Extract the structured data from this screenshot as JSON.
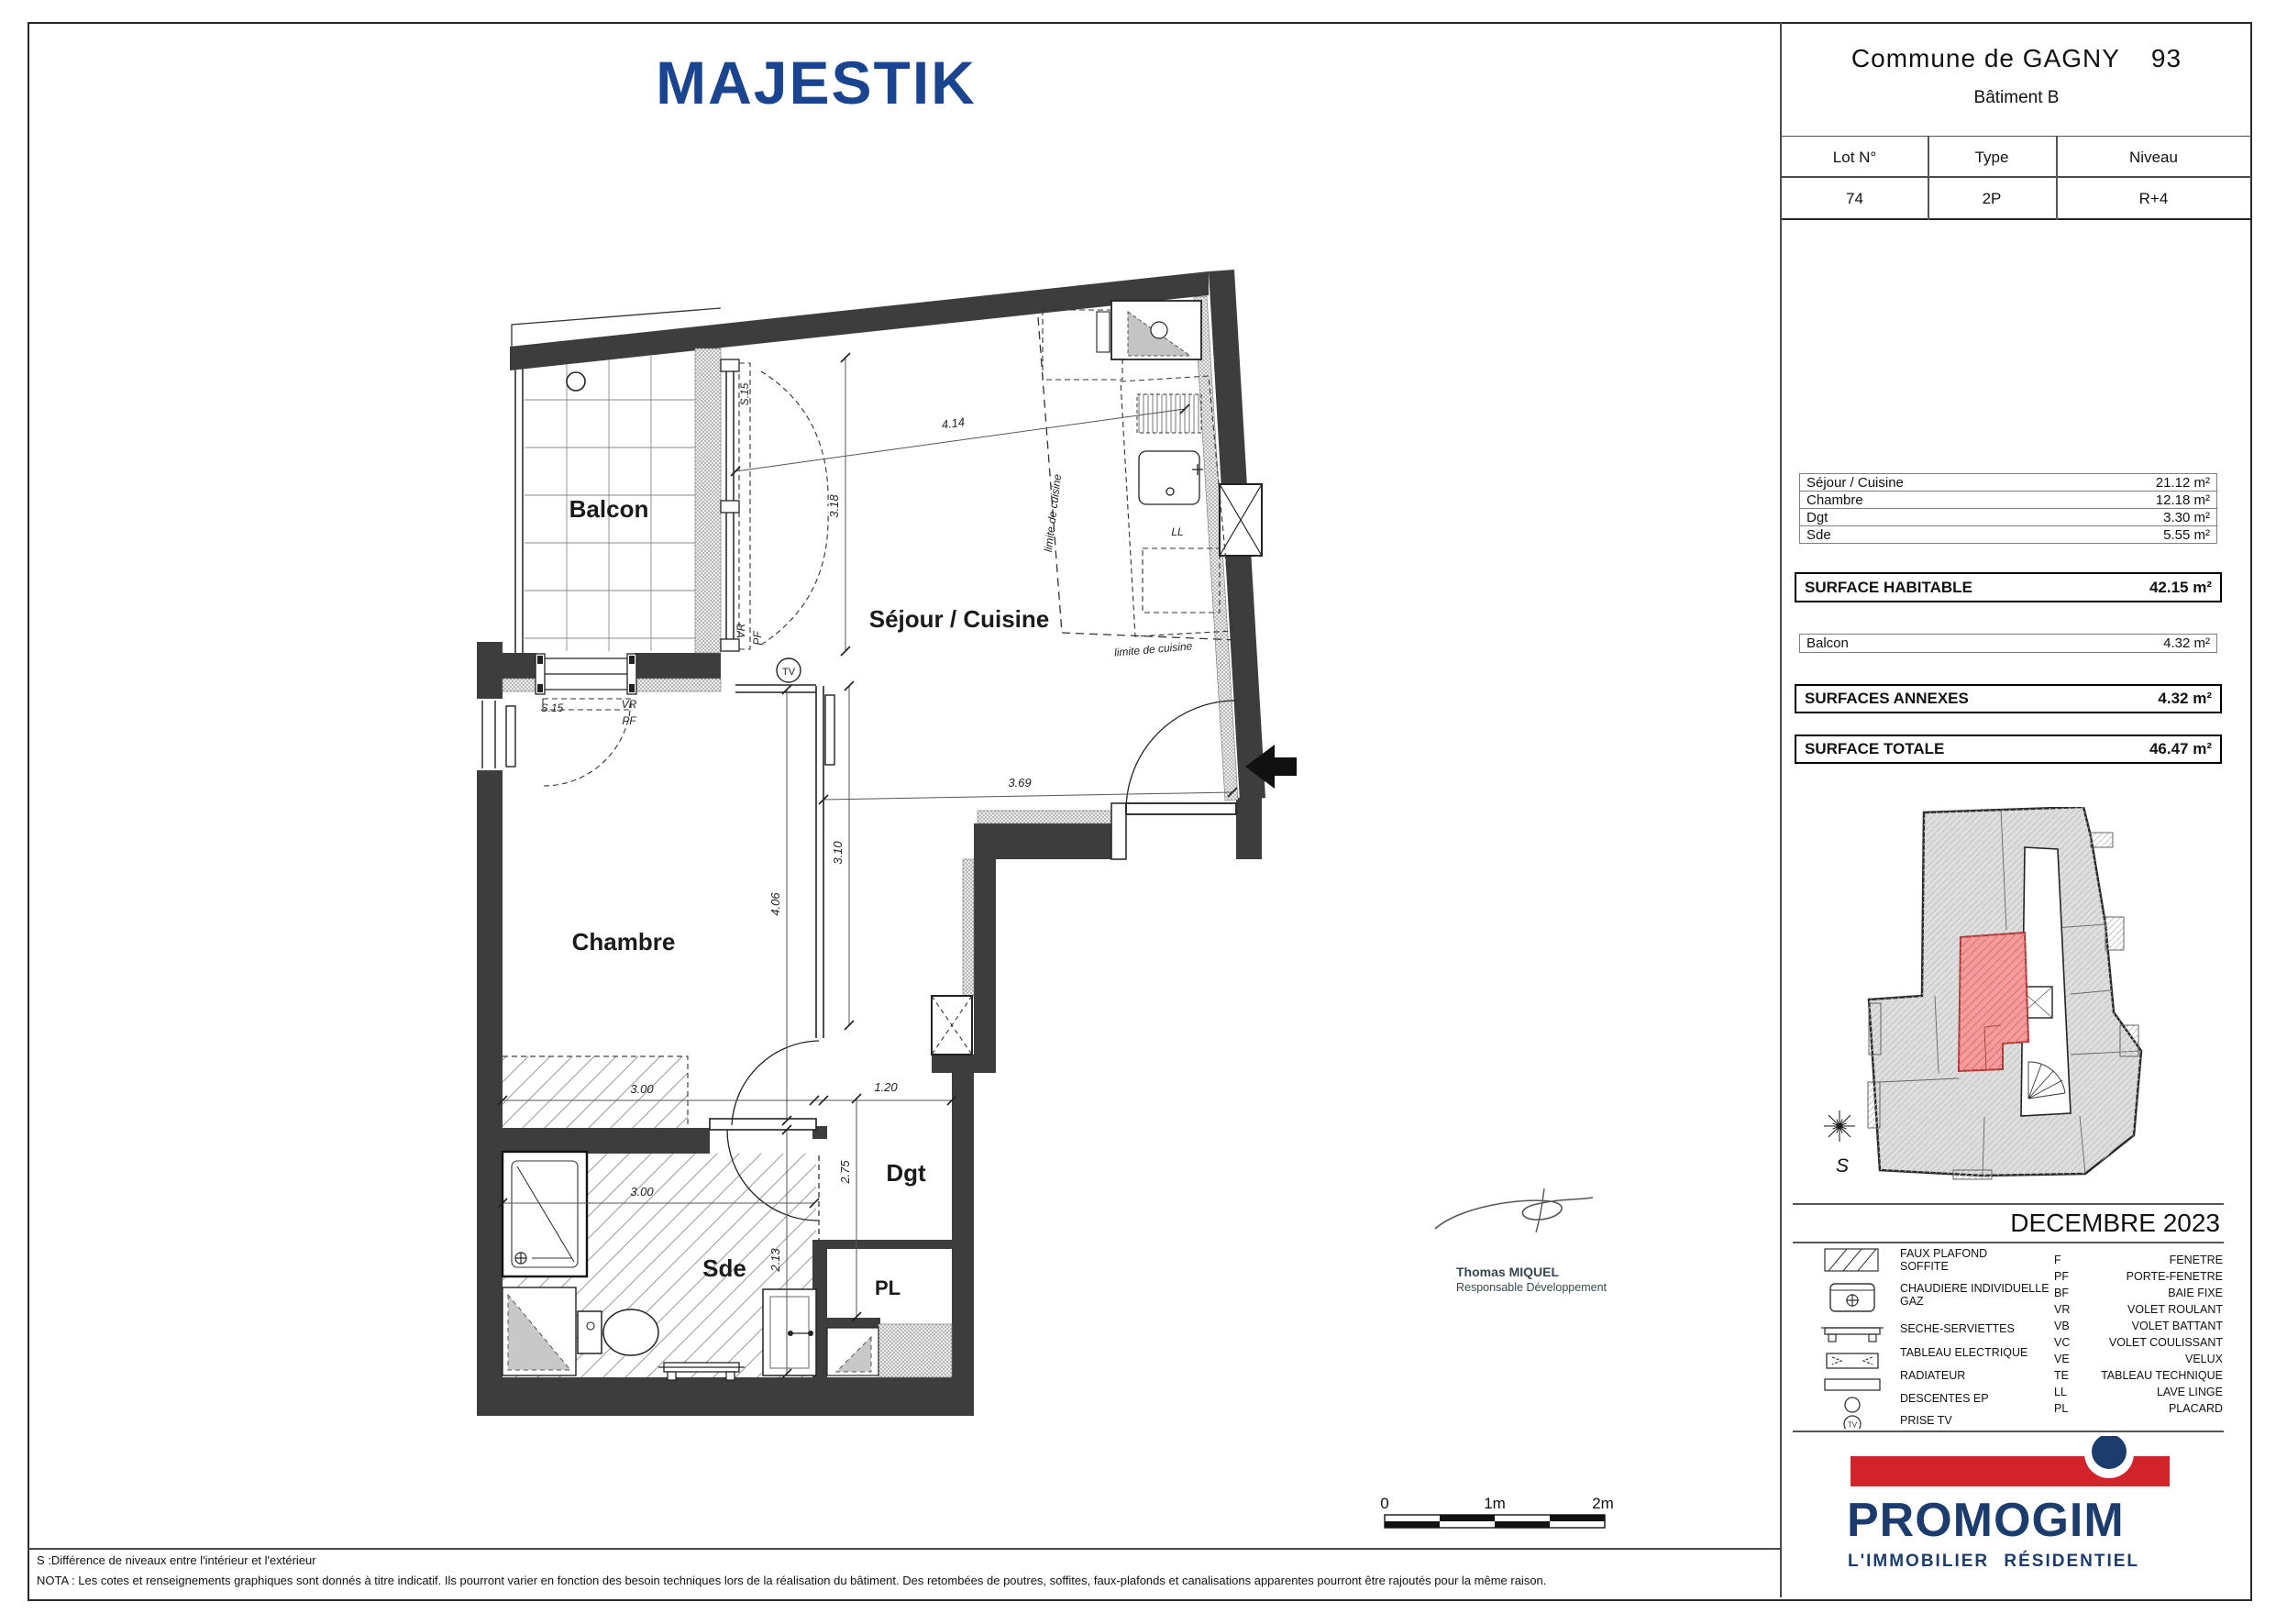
{
  "title": "MAJESTIK",
  "header": {
    "commune": "Commune de GAGNY",
    "dept": "93",
    "batiment": "Bâtiment B"
  },
  "lot_table": {
    "headers": [
      "Lot N°",
      "Type",
      "Niveau"
    ],
    "values": [
      "74",
      "2P",
      "R+4"
    ]
  },
  "surfaces": {
    "rooms": [
      {
        "label": "Séjour / Cuisine",
        "area": "21.12 m²"
      },
      {
        "label": "Chambre",
        "area": "12.18 m²"
      },
      {
        "label": "Dgt",
        "area": "3.30 m²"
      },
      {
        "label": "Sde",
        "area": "5.55 m²"
      }
    ],
    "habitable": {
      "label": "SURFACE HABITABLE",
      "area": "42.15 m²"
    },
    "annexe_rooms": [
      {
        "label": "Balcon",
        "area": "4.32 m²"
      }
    ],
    "annexes": {
      "label": "SURFACES ANNEXES",
      "area": "4.32 m²"
    },
    "totale": {
      "label": "SURFACE TOTALE",
      "area": "46.47 m²"
    }
  },
  "date": "DECEMBRE 2023",
  "legend": {
    "symbols": [
      {
        "icon": "faux-plafond",
        "lines": [
          "FAUX PLAFOND",
          "SOFFITE"
        ]
      },
      {
        "icon": "chaudiere",
        "lines": [
          "CHAUDIERE INDIVIDUELLE",
          "GAZ"
        ]
      },
      {
        "icon": "seche-serviettes",
        "lines": [
          "SECHE-SERVIETTES"
        ]
      },
      {
        "icon": "tableau-electrique",
        "lines": [
          "TABLEAU ELECTRIQUE"
        ]
      },
      {
        "icon": "radiateur",
        "lines": [
          "RADIATEUR"
        ]
      },
      {
        "icon": "descentes-ep",
        "lines": [
          "DESCENTES EP"
        ]
      },
      {
        "icon": "prise-tv",
        "lines": [
          "PRISE TV"
        ]
      }
    ],
    "abbrevs": [
      {
        "code": "F",
        "name": "FENETRE"
      },
      {
        "code": "PF",
        "name": "PORTE-FENETRE"
      },
      {
        "code": "BF",
        "name": "BAIE FIXE"
      },
      {
        "code": "VR",
        "name": "VOLET ROULANT"
      },
      {
        "code": "VB",
        "name": "VOLET BATTANT"
      },
      {
        "code": "VC",
        "name": "VOLET COULISSANT"
      },
      {
        "code": "VE",
        "name": "VELUX"
      },
      {
        "code": "TE",
        "name": "TABLEAU TECHNIQUE"
      },
      {
        "code": "LL",
        "name": "LAVE LINGE"
      },
      {
        "code": "PL",
        "name": "PLACARD"
      }
    ]
  },
  "logo": {
    "name": "PROMOGIM",
    "tagline": "L'IMMOBILIER RÉSIDENTIEL",
    "red": "#d2232a",
    "navy": "#1d3c6e"
  },
  "plan": {
    "room_labels": {
      "balcon": "Balcon",
      "sejour": "Séjour / Cuisine",
      "chambre": "Chambre",
      "sde": "Sde",
      "dgt": "Dgt",
      "pl": "PL"
    },
    "annotations": {
      "tv": "TV",
      "ll": "LL",
      "limite": "limite de cuisine",
      "s15": "S.15",
      "vr": "VR",
      "pf": "PF"
    },
    "dimensions": {
      "d414": "4.14",
      "d318": "3.18",
      "d369": "3.69",
      "d310": "3.10",
      "d406": "4.06",
      "d300_chambre": "3.00",
      "d120": "1.20",
      "d300_sde": "3.00",
      "d275": "2.75",
      "d213": "2.13"
    },
    "unit_highlight": "#f49b9b"
  },
  "scale_bar": {
    "labels": [
      "0",
      "1m",
      "2m"
    ]
  },
  "signature": {
    "name": "Thomas MIQUEL",
    "role": "Responsable Développement"
  },
  "compass": {
    "south": "S"
  },
  "notes": {
    "s_note": "S :Différence de niveaux entre l'intérieur et l'extérieur",
    "nota": "NOTA : Les cotes et renseignements graphiques sont donnés à titre indicatif. Ils pourront varier en fonction des besoin techniques lors de la réalisation du bâtiment. Des retombées de poutres, soffites, faux-plafonds et canalisations apparentes pourront être rajoutés pour la même raison."
  }
}
